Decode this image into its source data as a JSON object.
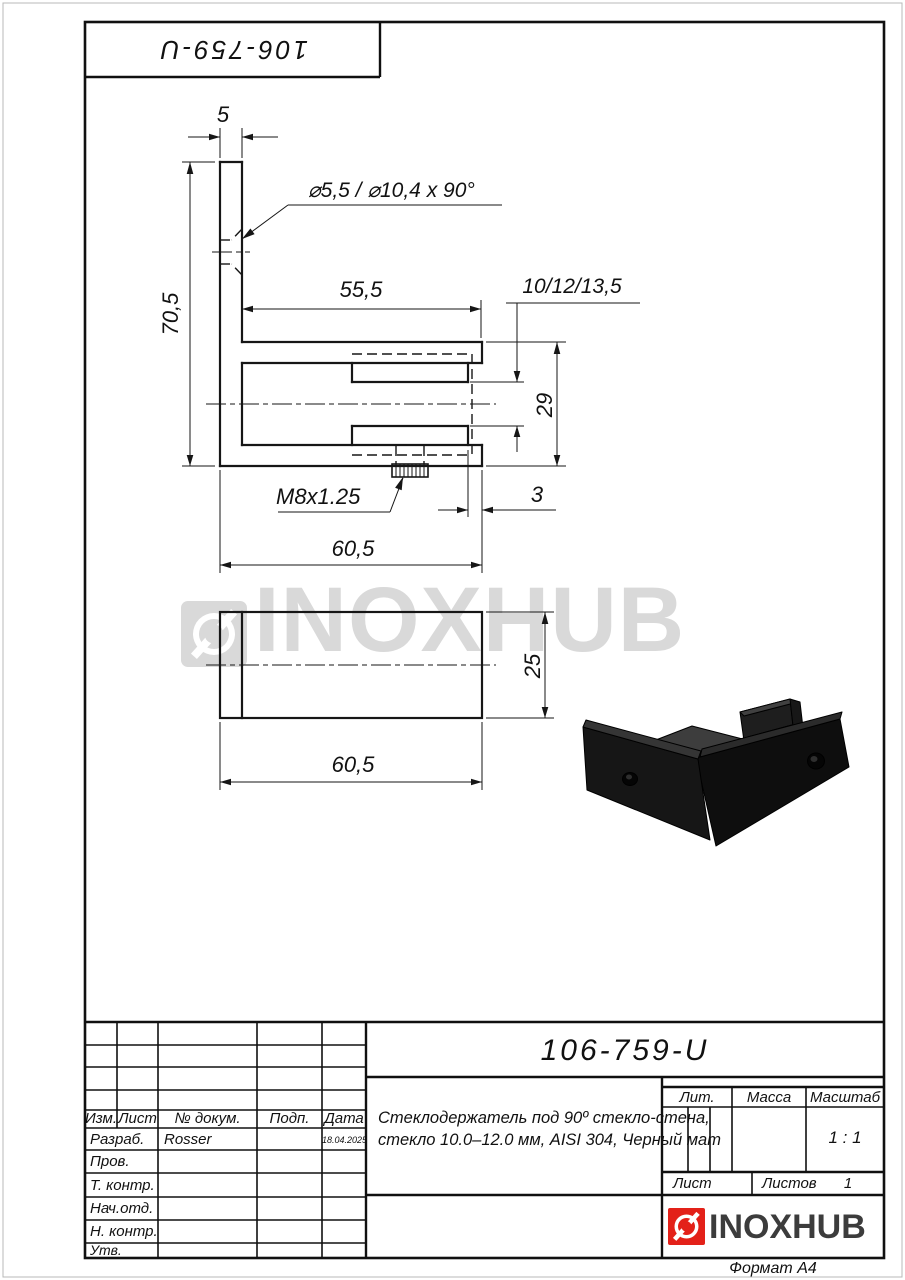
{
  "page": {
    "doc_number_top": "106-759-U",
    "format_label": "Формат А4"
  },
  "watermark": {
    "text": "INOXHUB"
  },
  "drawing": {
    "dims": {
      "wall_thickness": "5",
      "hole_callout": "⌀5,5 / ⌀10,4 x 90°",
      "height": "70,5",
      "arm_length": "55,5",
      "glass_range": "10/12/13,5",
      "channel_height": "29",
      "thread": "M8x1.25",
      "tip_offset": "3",
      "total_length": "60,5",
      "body_width": "25",
      "total_length_bottom": "60,5"
    }
  },
  "title_block": {
    "doc_number": "106-759-U",
    "description_line1": "Стеклодержатель под 90º стекло-стена,",
    "description_line2": "стекло 10.0–12.0 мм, AISI 304, Черный мат",
    "headers": {
      "izm": "Изм.",
      "list": "Лист",
      "doc": "№ докум.",
      "sign": "Подп.",
      "date": "Дата",
      "lit": "Лит.",
      "mass": "Масса",
      "scale": "Масштаб",
      "sheet": "Лист",
      "sheets": "Листов"
    },
    "rows": [
      {
        "label": "Разраб.",
        "value": "Rosser",
        "date": "18.04.2025"
      },
      {
        "label": "Пров.",
        "value": "",
        "date": ""
      },
      {
        "label": "Т. контр.",
        "value": "",
        "date": ""
      },
      {
        "label": "Нач.отд.",
        "value": "",
        "date": ""
      },
      {
        "label": "Н. контр.",
        "value": "",
        "date": ""
      },
      {
        "label": "Утв.",
        "value": "",
        "date": ""
      }
    ],
    "scale_value": "1 : 1",
    "sheets_value": "1",
    "logo_text": "INOXHUB"
  },
  "colors": {
    "accent_red": "#e32119",
    "logo_dark": "#3c3c3c",
    "watermark_gray": "#d9d9d9"
  }
}
